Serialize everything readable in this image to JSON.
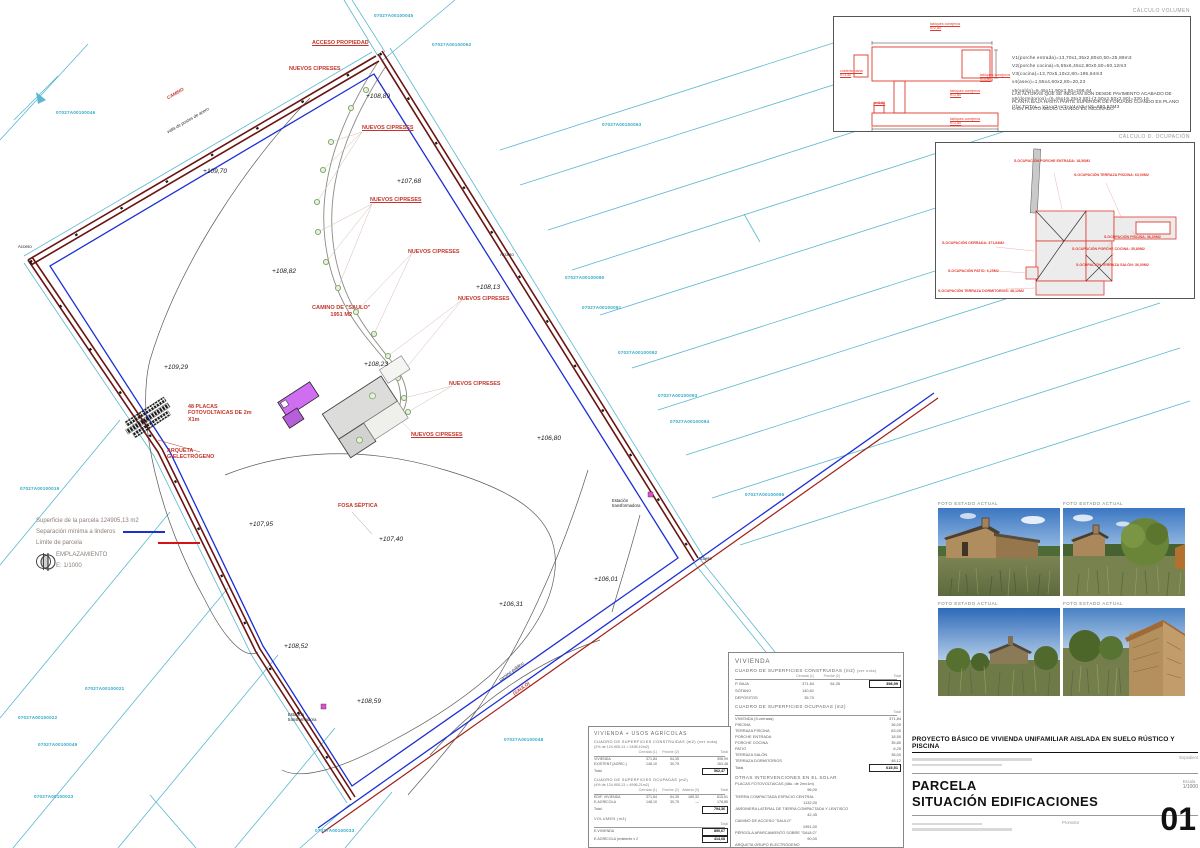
{
  "doc": {
    "project_title": "PROYECTO BÁSICO DE VIVIENDA UNIFAMILIAR AISLADA EN SUELO RÚSTICO Y PISCINA",
    "sheet_name_1": "PARCELA",
    "sheet_name_2": "SITUACIÓN EDIFICACIONES",
    "sheet_number": "01",
    "scale_label": "Escala",
    "scale_value": "1/1000",
    "promotor_label": "Promotor",
    "expedient_label": "Expedient"
  },
  "legend": {
    "area_line": "Superficie de la parcela 124905,13 m2",
    "sep_line": "Separación mínima a linderos",
    "limit_line": "Límite de parcela",
    "emplazamiento": "EMPLAZAMIENTO",
    "emplazamiento_scale": "E: 1/1000",
    "sep_color": "#1c2fd4",
    "limit_color": "#d41414"
  },
  "volumen": {
    "title": "CÁLCULO VOLUMEN",
    "lines": [
      "V1(porche entrada)=13,70x1,35x2,80x0,50=25,89m3",
      "V2(porche cocina)=5,55x6,45x2,80x0,50=50,12m3",
      "V3(cocina)=13,70x5,10x2,80=195,64m3",
      "v4(aseo)=1,55x4,60x2,80=20,23",
      "v5(salón)=6,45x11,90x3,50=268,64",
      "v6(dormitorios)=(6,45x19,25x2,80)-(2,50x2,50x2,80)=330,16",
      "(*)V TOTAL= V1+V2+V3+V4+V5+V6=890,67M3"
    ],
    "note": "LAS ALTURAS QUE SE INDICAN SON DESDE PAVIMENTO ACABADO DE PLANTA BAJA HASTA PARTE SUPERIOR DE FORJADO CUANDO ES PLANO O EN PUNTO MEDIO CUANDO ES INCLINADO",
    "diagram_labels": [
      {
        "text": "tabiques conejeros\nh=2,80",
        "x": 96,
        "y": 5
      },
      {
        "text": "cubierta plana\nh=3,50",
        "x": 6,
        "y": 52
      },
      {
        "text": "tabiques conejeros\nh=2,80",
        "x": 146,
        "y": 56
      },
      {
        "text": "tabiques conejeros\nh=2,80",
        "x": 116,
        "y": 72
      },
      {
        "text": "h=3,50",
        "x": 40,
        "y": 84
      },
      {
        "text": "tabiques conejeros\nh=2,80",
        "x": 116,
        "y": 100
      }
    ]
  },
  "ocupacion": {
    "title": "CÁLCULO D. OCUPACIÓN",
    "labels": [
      {
        "text": "S.OCUPACIÓN PORCHE ENTRADA: 18,50M2",
        "x": 78,
        "y": 16
      },
      {
        "text": "S.OCUPACIÓN TERRAZA PISCINA: 63,00M2",
        "x": 138,
        "y": 30
      },
      {
        "text": "S.OCUPACIÓN PISCINA: 36,00M2",
        "x": 168,
        "y": 92
      },
      {
        "text": "S.OCUPACIÓN PORCHE COCINA: 35,80M2",
        "x": 136,
        "y": 104
      },
      {
        "text": "S.OCUPACIÓN TERRAZA SALÓN: 36,00M2",
        "x": 140,
        "y": 120
      },
      {
        "text": "S.OCUPACIÓN CERRADA: 371,84M2",
        "x": 6,
        "y": 98
      },
      {
        "text": "S.OCUPACIÓN PATIO: 6,25M2",
        "x": 12,
        "y": 126
      },
      {
        "text": "S.OCUPACIÓN TERRAZA DORMITORIOS: 48,12M2",
        "x": 2,
        "y": 146
      }
    ]
  },
  "photos": {
    "captions": [
      "FOTO ESTADO ACTUAL",
      "FOTO ESTADO ACTUAL",
      "FOTO ESTADO ACTUAL",
      "FOTO ESTADO ACTUAL"
    ]
  },
  "tables": {
    "vivienda": {
      "title": "VIVIENDA",
      "s1_title": "CUADRO DE SUPERFICIES CONSTRUIDAS (m2)",
      "s1_note": "(ver nota)",
      "s1_rows": [
        {
          "label": "",
          "c1": "Cerrada (1)",
          "c2": "Porche (2)",
          "total": "Total",
          "cls": "head"
        },
        {
          "label": "P. BAJA",
          "c1": "371,84",
          "c2": "54,35",
          "total": "398,99",
          "note": "< 1873,57 m2",
          "cls": "totrow"
        },
        {
          "label": "SÓTANO",
          "c1": "140,81"
        },
        {
          "label": "DEPÓSITOS",
          "c1": "35,70"
        }
      ],
      "s2_title": "CUADRO DE SUPERFICIES OCUPADAS (m2)",
      "s2_rows": [
        {
          "label": "",
          "total": "Total",
          "cls": "head"
        },
        {
          "label": "VIVIENDA (S.cerrada)",
          "total": "371,84"
        },
        {
          "label": "PISCINA",
          "total": "36,00"
        },
        {
          "label": "TERRAZA PISCINA",
          "total": "63,00"
        },
        {
          "label": "PORCHE ENTRADA",
          "total": "18,50"
        },
        {
          "label": "PORCHE COCINA",
          "total": "35,80"
        },
        {
          "label": "PATIO",
          "total": "6,25"
        },
        {
          "label": "TERRAZA SALÓN",
          "total": "36,00"
        },
        {
          "label": "TERRAZA DORMITORIOS",
          "total": "48,12"
        },
        {
          "label": "Total",
          "total": "615,51",
          "note": "< 4996,21 m2",
          "cls": "totrow"
        }
      ],
      "s3_title": "OTRAS INTERVENCIONES EN EL SOLAR",
      "s3_rows": [
        {
          "label": "PLACAS FOTOVOLTAICAS (48u. de 2mx1m)",
          "total": "96,00"
        },
        {
          "label": "TIERRA COMPACTADA ESPACIO CENTRAL",
          "total": "1132,00"
        },
        {
          "label": "JARDINERA LATERAL DE TIERRA COMPACTADA Y LENTISCO",
          "total": "42,45"
        },
        {
          "label": "CAMINO DE ACCESO \"SAULO\"",
          "total": "1951,00"
        },
        {
          "label": "PÉRGOLA APARCAMIENTO SOBRE \"SAULO\"",
          "total": "90,00"
        },
        {
          "label": "ARQUETA GRUPO ELECTRÓGENO",
          "total": "1,00"
        },
        {
          "label": "ARQUETA FOSA SÉPTICA",
          "total": "1,00"
        }
      ]
    },
    "mixta": {
      "title": "VIVIENDA + USOS AGRÍCOLAS",
      "s1_title": "CUADRO DE SUPERFICIES CONSTRUIDAS (m2)",
      "s1_note": "(ver nota)",
      "s1_sub": "(2% de 124.905,13 = 2498,10m2)",
      "s1_rows": [
        {
          "label": "",
          "c1": "Cerrada (1)",
          "c2": "Porche (2)",
          "total": "Total",
          "cls": "head"
        },
        {
          "label": "VIVIENDA",
          "c1": "371,84",
          "c2": "54,35",
          "total": "398,99"
        },
        {
          "label": "EXISTENT.(AGRÍC.)",
          "c1": "148,10",
          "c2": "30,75",
          "total": "163,48"
        },
        {
          "label": "Total",
          "total": "562,47",
          "note": "< 2498,10 m2",
          "cls": "totrow"
        }
      ],
      "s2_title": "CUADRO DE SUPERFICIES OCUPADAS (m2)",
      "s2_sub": "(4% de 124.905,13 = 4996,21m2)",
      "s2_rows": [
        {
          "label": "",
          "c1": "Cerrada (1)",
          "c2": "Porche (2)",
          "c3": "Abierto (3)",
          "total": "Total",
          "cls": "head"
        },
        {
          "label": "EDIF. VIVIENDA",
          "c1": "371,84",
          "c2": "54,35",
          "c3": "189,32",
          "total": "615,51"
        },
        {
          "label": "E.AGRÍCOLA",
          "c1": "148,10",
          "c2": "30,75",
          "c3": "—",
          "total": "178,85"
        },
        {
          "label": "Total",
          "total": "794,36",
          "note": "< 4996,21 m2",
          "cls": "totrow"
        }
      ],
      "s3_title": "VOLUMEN (m3)",
      "s3_rows": [
        {
          "label": "",
          "total": "Total",
          "cls": "head"
        },
        {
          "label": "E.VIVIENDA",
          "total": "890,67",
          "cls": "totrow"
        },
        {
          "label": "E.AGRÍCOLA (existente x 2,80)",
          "total": "414,68",
          "cls": "totrow"
        }
      ]
    }
  },
  "plan": {
    "labels": [
      {
        "text": "07027A00100045",
        "x": 374,
        "y": 13,
        "cls": "cad"
      },
      {
        "text": "07027A00100062",
        "x": 432,
        "y": 42,
        "cls": "cad"
      },
      {
        "text": "07027A00100046",
        "x": 56,
        "y": 110,
        "cls": "cad"
      },
      {
        "text": "07027A00100063",
        "x": 602,
        "y": 122,
        "cls": "cad"
      },
      {
        "text": "07027A00100090",
        "x": 565,
        "y": 275,
        "cls": "cad"
      },
      {
        "text": "07027A00100091",
        "x": 582,
        "y": 305,
        "cls": "cad"
      },
      {
        "text": "07027A00100092",
        "x": 618,
        "y": 350,
        "cls": "cad"
      },
      {
        "text": "07027A00100093",
        "x": 658,
        "y": 393,
        "cls": "cad"
      },
      {
        "text": "07027A00100094",
        "x": 670,
        "y": 419,
        "cls": "cad"
      },
      {
        "text": "07027A00100095",
        "x": 745,
        "y": 492,
        "cls": "cad"
      },
      {
        "text": "07027A00100019",
        "x": 20,
        "y": 486,
        "cls": "cad"
      },
      {
        "text": "07027A00100021",
        "x": 85,
        "y": 686,
        "cls": "cad"
      },
      {
        "text": "07027A00100022",
        "x": 18,
        "y": 715,
        "cls": "cad"
      },
      {
        "text": "07027A00100049",
        "x": 38,
        "y": 742,
        "cls": "cad"
      },
      {
        "text": "07027A00100023",
        "x": 34,
        "y": 794,
        "cls": "cad"
      },
      {
        "text": "07027A00100048",
        "x": 504,
        "y": 737,
        "cls": "cad"
      },
      {
        "text": "07027A00100033",
        "x": 315,
        "y": 828,
        "cls": "cad"
      },
      {
        "text": "ACCESO PROPIEDAD",
        "x": 312,
        "y": 40,
        "cls": "redu"
      },
      {
        "text": "NUEVOS CIPRESES",
        "x": 289,
        "y": 66,
        "cls": "red"
      },
      {
        "text": "NUEVOS CIPRESES",
        "x": 362,
        "y": 125,
        "cls": "redu"
      },
      {
        "text": "NUEVOS CIPRESES",
        "x": 370,
        "y": 197,
        "cls": "redu"
      },
      {
        "text": "NUEVOS CIPRESES",
        "x": 408,
        "y": 249,
        "cls": "red"
      },
      {
        "text": "NUEVOS CIPRESES",
        "x": 458,
        "y": 296,
        "cls": "red"
      },
      {
        "text": "CAMINO DE \"SAULO\"\n1951 M2",
        "x": 312,
        "y": 305,
        "cls": "redc"
      },
      {
        "text": "NUEVOS CIPRESES",
        "x": 449,
        "y": 381,
        "cls": "red"
      },
      {
        "text": "NUEVOS CIPRESES",
        "x": 411,
        "y": 432,
        "cls": "redu"
      },
      {
        "text": "48 PLACAS\nFOTOVOLTAICAS DE 2m\nX1m",
        "x": 188,
        "y": 404,
        "cls": "red"
      },
      {
        "text": "ARQUETA\nG.ELECTRÓGENO",
        "x": 167,
        "y": 448,
        "cls": "red"
      },
      {
        "text": "FOSA SÉPTICA",
        "x": 338,
        "y": 503,
        "cls": "red"
      },
      {
        "text": "+108,89",
        "x": 366,
        "y": 93,
        "cls": "elev"
      },
      {
        "text": "+109,70",
        "x": 203,
        "y": 168,
        "cls": "elev"
      },
      {
        "text": "+107,68",
        "x": 397,
        "y": 178,
        "cls": "elev"
      },
      {
        "text": "+108,82",
        "x": 272,
        "y": 268,
        "cls": "elev"
      },
      {
        "text": "+108,13",
        "x": 476,
        "y": 284,
        "cls": "elev"
      },
      {
        "text": "+109,29",
        "x": 164,
        "y": 364,
        "cls": "elev"
      },
      {
        "text": "+108,23",
        "x": 364,
        "y": 361,
        "cls": "elev"
      },
      {
        "text": "+106,80",
        "x": 537,
        "y": 435,
        "cls": "elev"
      },
      {
        "text": "+107,95",
        "x": 249,
        "y": 521,
        "cls": "elev"
      },
      {
        "text": "+107,40",
        "x": 379,
        "y": 536,
        "cls": "elev"
      },
      {
        "text": "+106,01",
        "x": 594,
        "y": 576,
        "cls": "elev"
      },
      {
        "text": "+106,31",
        "x": 499,
        "y": 601,
        "cls": "elev"
      },
      {
        "text": "+108,52",
        "x": 284,
        "y": 643,
        "cls": "elev"
      },
      {
        "text": "+108,59",
        "x": 357,
        "y": 698,
        "cls": "elev"
      },
      {
        "text": "Estación\ntransformadora",
        "x": 612,
        "y": 498,
        "cls": "tiny"
      },
      {
        "text": "Estación\ntransformadora",
        "x": 288,
        "y": 712,
        "cls": "tiny"
      },
      {
        "text": "Acceso",
        "x": 18,
        "y": 244,
        "cls": "tiny"
      },
      {
        "text": "Acceso",
        "x": 500,
        "y": 252,
        "cls": "tiny"
      },
      {
        "text": "Acceso",
        "x": 698,
        "y": 556,
        "cls": "tiny"
      },
      {
        "text": "CAMINO",
        "x": 166,
        "y": 96,
        "cls": "redroad",
        "rot": -30
      },
      {
        "text": "valla de postes de acero",
        "x": 166,
        "y": 130,
        "cls": "roadlbl",
        "rot": -30
      },
      {
        "text": "camino público",
        "x": 498,
        "y": 678,
        "cls": "roadlbl",
        "rot": -36
      },
      {
        "text": "(SAULO)",
        "x": 512,
        "y": 692,
        "cls": "redroad",
        "rot": -36
      }
    ]
  }
}
